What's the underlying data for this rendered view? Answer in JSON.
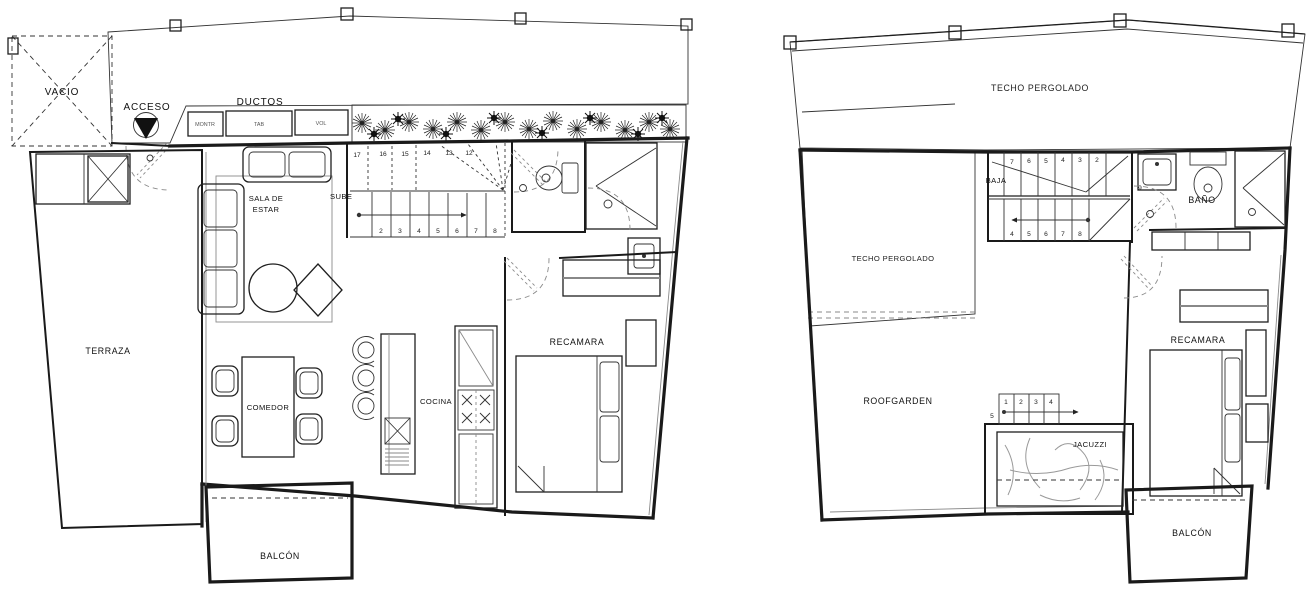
{
  "page": {
    "paper_color": "#ffffff",
    "ink_color": "#1a1a1a",
    "hatch_color": "#8a8a8a"
  },
  "plan1": {
    "labels": {
      "vacio": "VACIO",
      "acceso": "ACCESO",
      "ductos": "DUCTOS",
      "terraza": "TERRAZA",
      "sala_line1": "SALA DE",
      "sala_line2": "ESTAR",
      "sube": "SUBE",
      "comedor": "COMEDOR",
      "cocina": "COCINA",
      "recamara": "RECAMARA",
      "balcon": "BALCÓN"
    },
    "duct_boxes": [
      "MONTR",
      "TAB",
      "VOL"
    ],
    "stairs": {
      "upper_numbers": [
        "17",
        "16",
        "15",
        "14",
        "13",
        "12"
      ],
      "lower_numbers": [
        "2",
        "3",
        "4",
        "5",
        "6",
        "7",
        "8"
      ]
    }
  },
  "plan2": {
    "labels": {
      "techo_pergolado_top": "TECHO PERGOLADO",
      "techo_pergolado_left": "TECHO PERGOLADO",
      "baja": "BAJA",
      "bano": "BAÑO",
      "recamara": "RECAMARA",
      "roofgarden": "ROOFGARDEN",
      "jacuzzi": "JACUZZI",
      "balcon": "BALCÓN"
    },
    "stairs": {
      "upper_numbers": [
        "7",
        "6",
        "5",
        "4",
        "3",
        "2"
      ],
      "lower_numbers": [
        "4",
        "5",
        "6",
        "7",
        "8"
      ],
      "landing_number": "9"
    },
    "jacuzzi_steps": {
      "top_numbers": [
        "1",
        "2",
        "3",
        "4"
      ],
      "side_number": "5"
    }
  }
}
